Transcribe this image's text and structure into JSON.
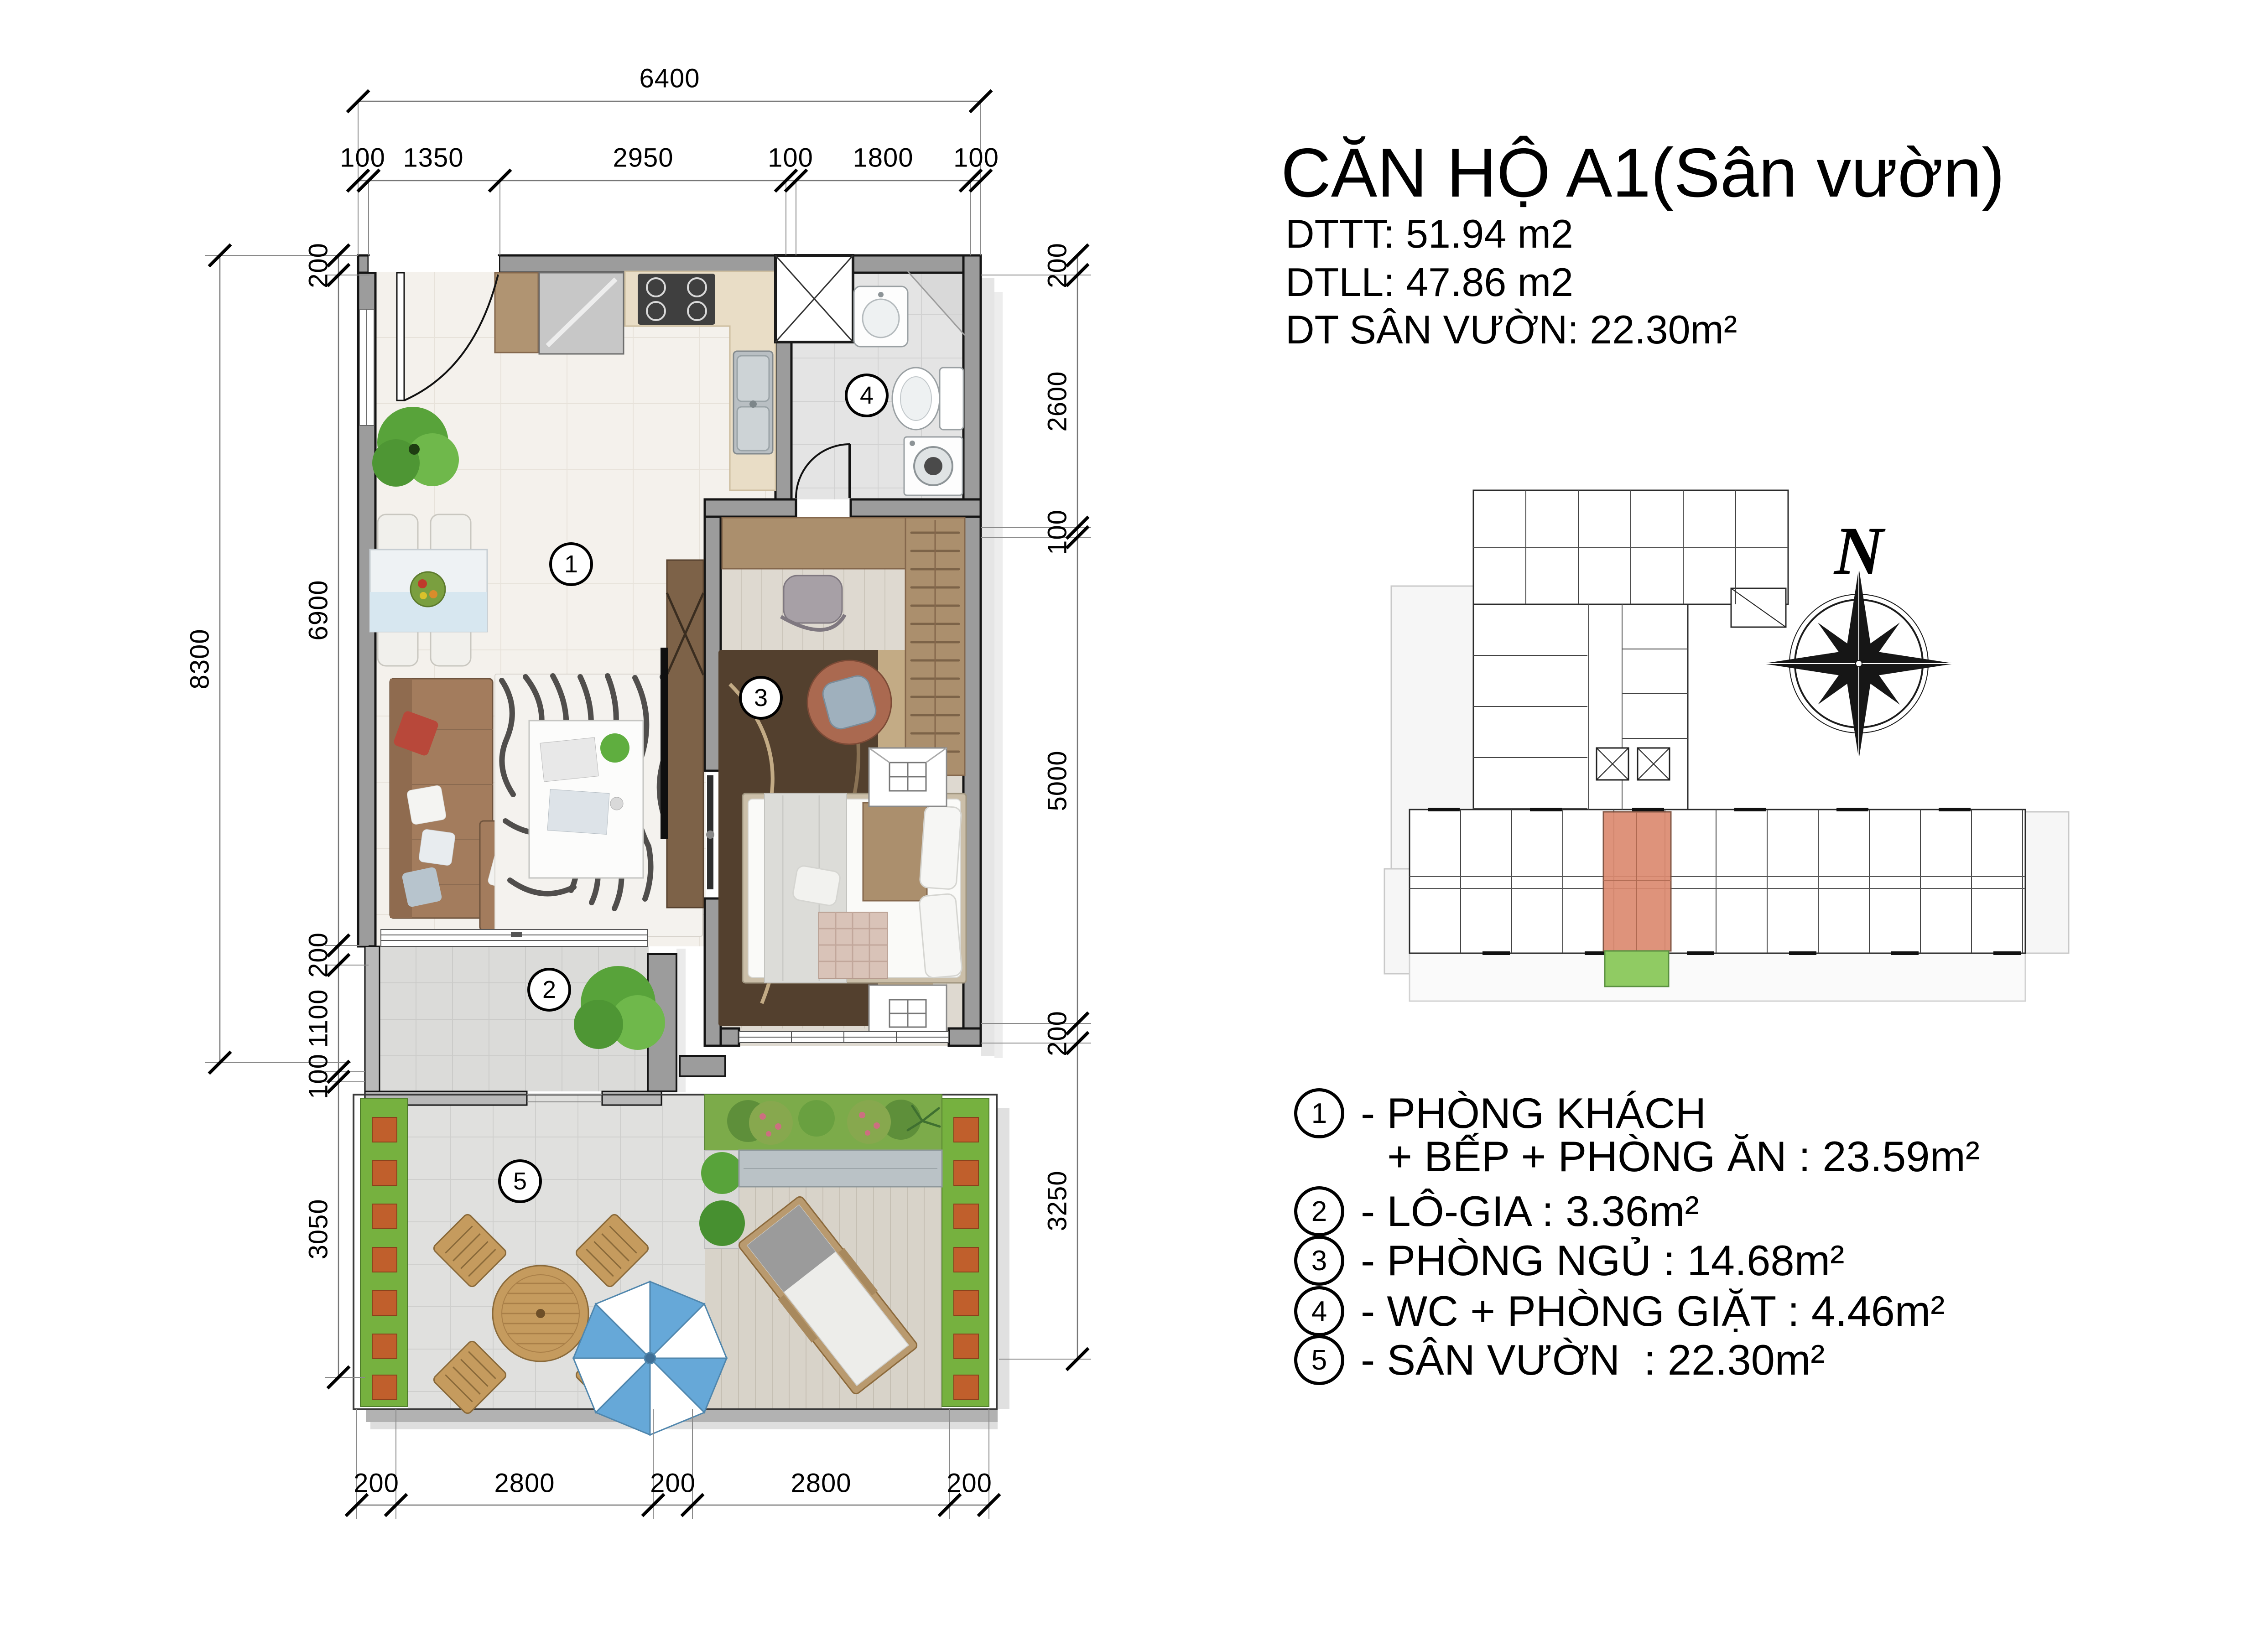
{
  "title": {
    "heading": "CĂN HỘ A1(Sân vườn)",
    "line1": "DTTT: 51.94 m2",
    "line2": "DTLL: 47.86 m2",
    "line3": "DT SÂN VƯỜN: 22.30m²"
  },
  "legend": {
    "items": [
      {
        "num": "1",
        "text": "- PHÒNG KHÁCH",
        "text2": "+ BẾP + PHÒNG ĂN : 23.59m²"
      },
      {
        "num": "2",
        "text": "- LÔ-GIA : 3.36m²"
      },
      {
        "num": "3",
        "text": "- PHÒNG NGỦ : 14.68m²"
      },
      {
        "num": "4",
        "text": "- WC + PHÒNG GIẶT : 4.46m²"
      },
      {
        "num": "5",
        "text": "- SÂN VƯỜN  : 22.30m²"
      }
    ]
  },
  "plan_labels": [
    "1",
    "2",
    "3",
    "4",
    "5"
  ],
  "compass": {
    "north": "N"
  },
  "dimensions": {
    "top_total": "6400",
    "top_row": [
      "100",
      "1350",
      "2950",
      "100",
      "1800",
      "100"
    ],
    "left_total": "8300",
    "left_row": [
      "200",
      "6900",
      "200",
      "1100",
      "100",
      "3050"
    ],
    "right_row": [
      "200",
      "2600",
      "100",
      "5000",
      "200",
      "3250"
    ],
    "bottom_row": [
      "200",
      "2800",
      "200",
      "2800",
      "200"
    ]
  },
  "colors": {
    "highlight_unit": "#dc8a70",
    "highlight_garden": "#90cb63",
    "umbrella_blue": "#66a8d8",
    "wall_gray": "#9c9c9c",
    "planter_green": "#76b13f"
  }
}
